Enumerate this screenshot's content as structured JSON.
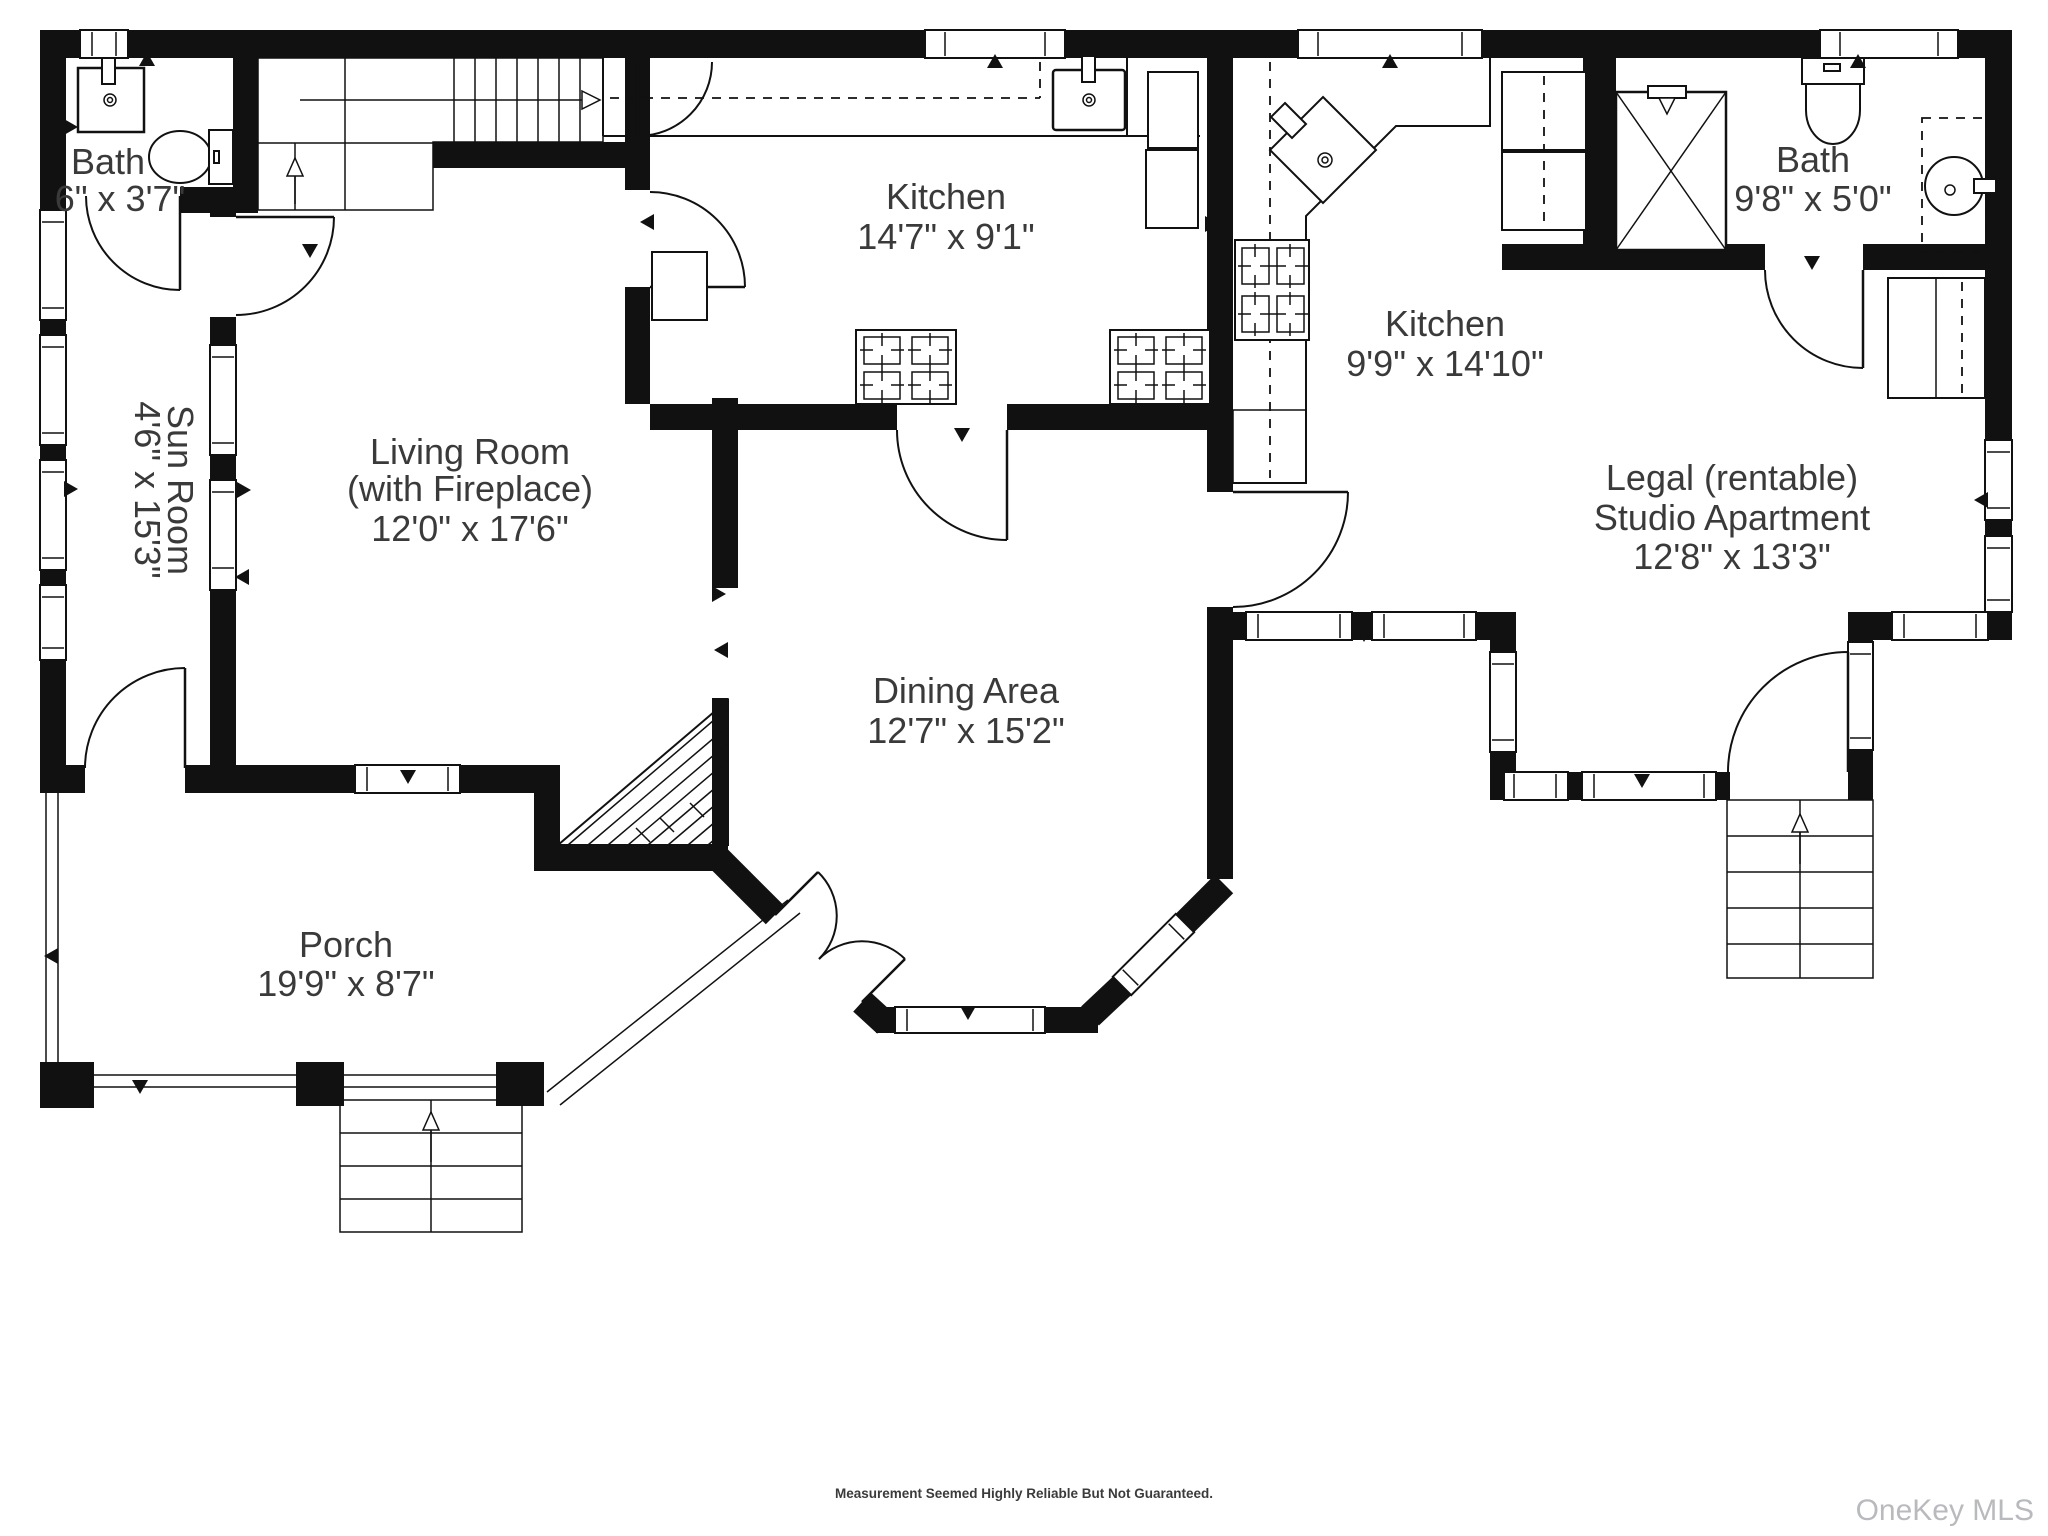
{
  "rooms": {
    "bath_main": {
      "name": "Bath",
      "dims": "6\" x 3'7\""
    },
    "sun_room": {
      "name": "Sun Room",
      "dims": "4'6\" x 15'3\""
    },
    "living_room": {
      "name": "Living Room",
      "sub": "(with Fireplace)",
      "dims": "12'0\" x 17'6\""
    },
    "kitchen_main": {
      "name": "Kitchen",
      "dims": "14'7\" x 9'1\""
    },
    "dining_area": {
      "name": "Dining Area",
      "dims": "12'7\" x 15'2\""
    },
    "kitchen_studio": {
      "name": "Kitchen",
      "dims": "9'9\" x 14'10\""
    },
    "bath_studio": {
      "name": "Bath",
      "dims": "9'8\" x 5'0\""
    },
    "studio": {
      "line1": "Legal (rentable)",
      "line2": "Studio Apartment",
      "dims": "12'8\" x 13'3\""
    },
    "porch": {
      "name": "Porch",
      "dims": "19'9\" x 8'7\""
    }
  },
  "footer": "Measurement Seemed Highly Reliable But Not Guaranteed.",
  "watermark": "OneKey MLS",
  "colors": {
    "wall": "#111111",
    "label": "#3a3a3a",
    "watermark": "#b8babd"
  },
  "icons": [
    "sink-icon",
    "toilet-icon",
    "shower-icon",
    "stove-icon",
    "refrigerator-icon",
    "corner-sink-icon",
    "staircase-icon",
    "door-arc-icon",
    "window-icon",
    "fireplace-icon"
  ]
}
